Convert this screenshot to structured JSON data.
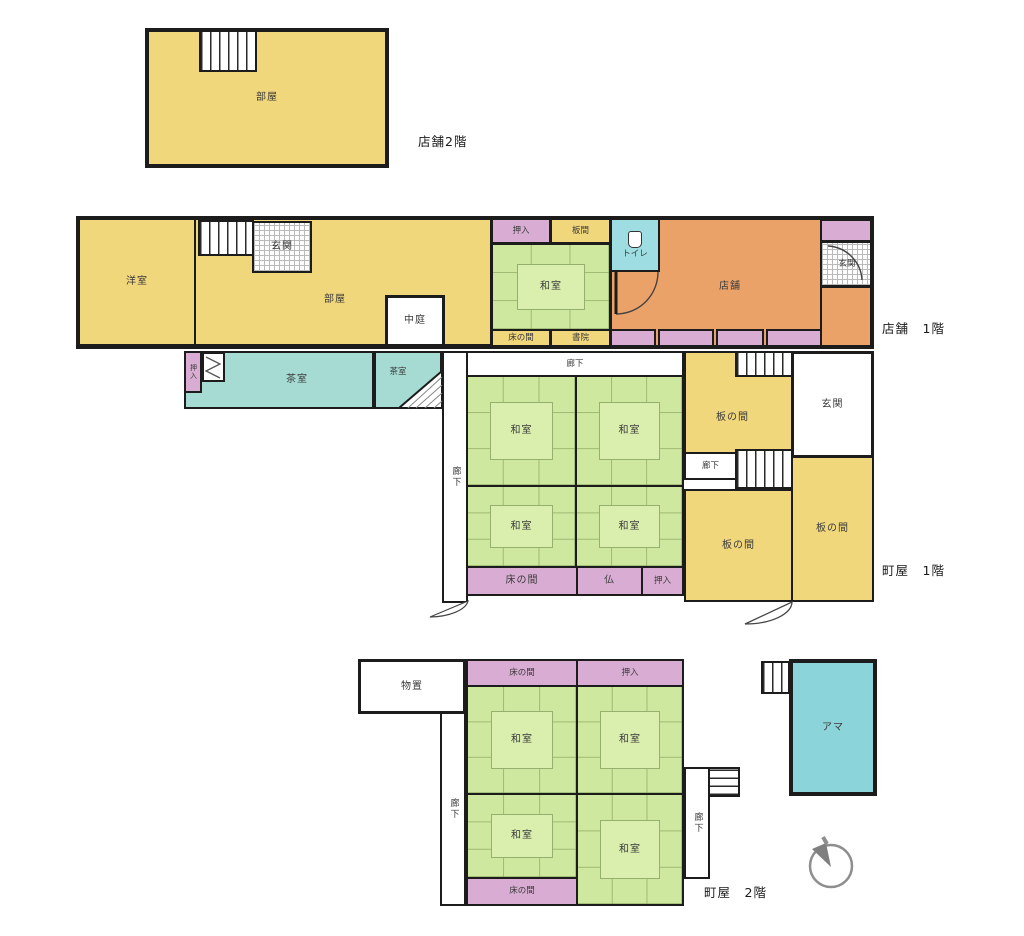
{
  "palette": {
    "wall": "#1c1c1c",
    "room_yellow": "#f1d77c",
    "tatami_green": "#cfe8a0",
    "tatami_mat": "#daefae",
    "closet_pink": "#d9add3",
    "shop_orange": "#eba269",
    "tea_room_teal": "#a6dbd3",
    "ama_cyan": "#8bd5da",
    "toilet_cyan": "#9edde2",
    "floor_white": "#ffffff"
  },
  "floors": {
    "shop2f": {
      "caption": "店舗2階",
      "rooms": {
        "heya": "部屋"
      }
    },
    "shop1f": {
      "caption": "店舗　1階",
      "rooms": {
        "yoshitsu": "洋室",
        "genkan": "玄関",
        "heya": "部屋",
        "nakaniwa": "中庭",
        "oshiire": "押入",
        "itama": "板間",
        "washitsu": "和室",
        "tokonoma": "床の間",
        "shoin": "書院",
        "toire": "トイレ",
        "tenpo": "店舗",
        "genkan2": "玄関"
      }
    },
    "machiya1f": {
      "caption": "町屋　1階",
      "rooms": {
        "oshiire_annex": "押入",
        "chashitsu_l": "茶室",
        "chashitsu_s": "茶室",
        "roka_left": "廊下",
        "roka_top": "廊下",
        "washitsu_tl": "和室",
        "washitsu_tr": "和室",
        "washitsu_bl": "和室",
        "washitsu_br": "和室",
        "tokonoma": "床の間",
        "butsu": "仏",
        "oshiire": "押入",
        "itanoma_top": "板の間",
        "genkan": "玄関",
        "roka_small": "廊下",
        "itanoma_bottom": "板の間",
        "itanoma_right": "板の間"
      }
    },
    "machiya2f": {
      "caption": "町屋　2階",
      "rooms": {
        "monooki": "物置",
        "tokonoma_top": "床の間",
        "oshiire_top": "押入",
        "washitsu_tl": "和室",
        "washitsu_tr": "和室",
        "washitsu_bl": "和室",
        "washitsu_br": "和室",
        "roka_left": "廊下",
        "roka_right": "廊下",
        "tokonoma_bottom": "床の間",
        "ama": "アマ"
      }
    }
  },
  "icons": {
    "compass": "compass-north-icon",
    "toilet": "toilet-icon",
    "stairs": "stairs-icon",
    "door_swing": "door-swing-icon",
    "folding_door": "folding-door-icon"
  }
}
